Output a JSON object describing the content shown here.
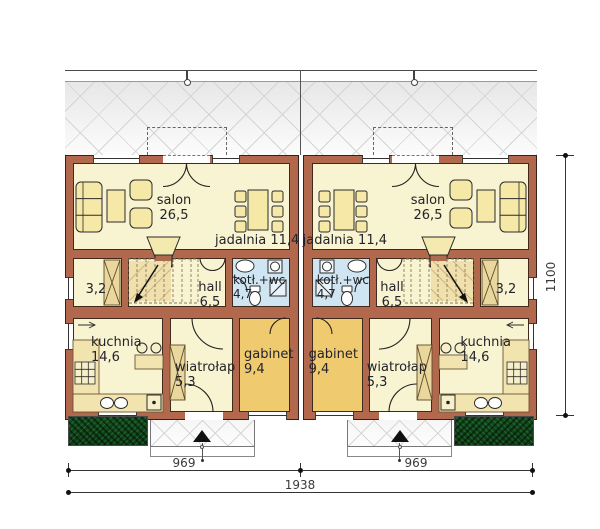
{
  "rooms": {
    "salon": {
      "name": "salon",
      "area": "26,5"
    },
    "jadalnia": {
      "name": "jadalnia",
      "area": "11,4"
    },
    "storage": {
      "area": "3,2"
    },
    "hall": {
      "name": "hall",
      "area": "6,5"
    },
    "boiler_wc": {
      "name": "kotł.+wc",
      "area": "4,7"
    },
    "kitchen": {
      "name": "kuchnia",
      "area": "14,6"
    },
    "vestibule": {
      "name": "wiatrołap",
      "area": "5,3"
    },
    "study": {
      "name": "gabinet",
      "area": "9,4"
    }
  },
  "dimensions": {
    "span_left": "969",
    "span_right": "969",
    "total": "1938",
    "depth": "1100"
  },
  "colors": {
    "wall": "#b2684c",
    "floor_cream": "#f8f3d0",
    "floor_study": "#f0ca6e",
    "floor_bath": "#cfe5f1",
    "furniture": "#f6e8a6",
    "planter_green": "#134d1f"
  }
}
